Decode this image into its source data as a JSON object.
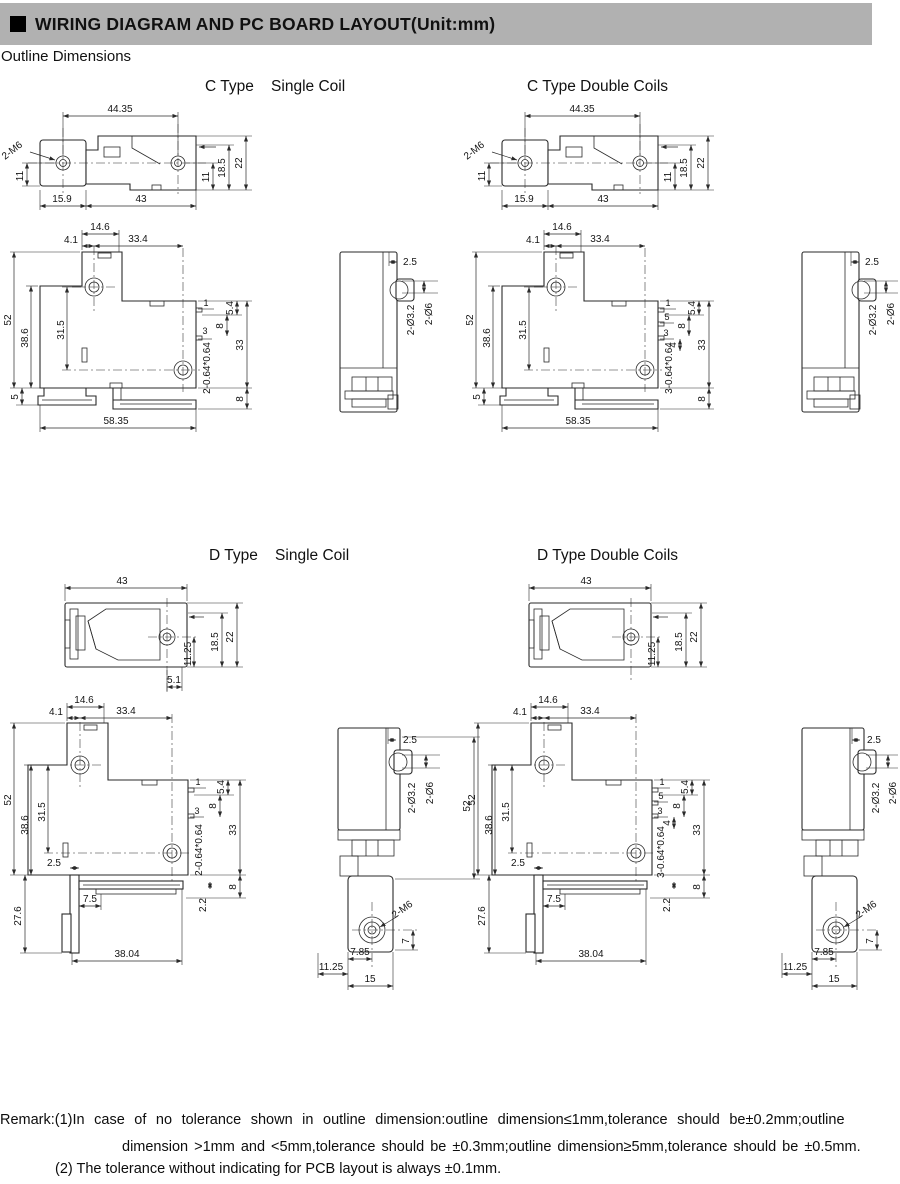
{
  "colors": {
    "header_bar": "#b1b1b1",
    "line": "#2a2a2a"
  },
  "header": {
    "title": "WIRING DIAGRAM AND PC BOARD LAYOUT(Unit:mm)"
  },
  "section_label": "Outline Dimensions",
  "drawings": {
    "c_single": {
      "title": "C Type    Single Coil",
      "top": {
        "holes_span": "44.35",
        "thread": "2-M6",
        "left_h": "11",
        "off1": "15.9",
        "off2": "43",
        "r1": "11",
        "r2": "18.5",
        "r3": "22"
      },
      "front": {
        "t1": "14.6",
        "t2": "4.1",
        "t3": "33.4",
        "l1": "52",
        "l2": "38.6",
        "l3": "31.5",
        "p1": "1",
        "p2": "5.4",
        "p3": "8",
        "p4": "3",
        "r1": "33",
        "pin": "2-0.64*0.64",
        "b1": "5",
        "b2": "58.35",
        "r2": "8"
      },
      "side": {
        "t1": "2.5",
        "h1": "2-Ø3.2",
        "h2": "2-Ø6"
      }
    },
    "c_double": {
      "title": "C Type Double Coils",
      "top": {
        "holes_span": "44.35",
        "thread": "2-M6",
        "left_h": "11",
        "off1": "15.9",
        "off2": "43",
        "r1": "11",
        "r2": "18.5",
        "r3": "22"
      },
      "front": {
        "t1": "14.6",
        "t2": "4.1",
        "t3": "33.4",
        "l1": "52",
        "l2": "38.6",
        "l3": "31.5",
        "p1": "1",
        "p2": "5.4",
        "p3": "8",
        "p4": "3",
        "p5": "5",
        "p6": "4",
        "r1": "33",
        "pin": "3-0.64*0.64",
        "b1": "5",
        "b2": "58.35",
        "r2": "8"
      },
      "side": {
        "t1": "2.5",
        "h1": "2-Ø3.2",
        "h2": "2-Ø6"
      }
    },
    "d_single": {
      "title": "D Type    Single Coil",
      "top": {
        "w": "43",
        "r1": "11.25",
        "r2": "18.5",
        "r3": "22",
        "b1": "5.1"
      },
      "front": {
        "t1": "14.6",
        "t2": "4.1",
        "t3": "33.4",
        "l1": "52",
        "l2": "38.6",
        "l3": "31.5",
        "p1": "1",
        "p2": "5.4",
        "p3": "8",
        "p4": "3",
        "r1": "33",
        "pin": "2-0.64*0.64",
        "plate": "2.5",
        "l4": "27.6",
        "b1": "7.5",
        "b2": "38.04",
        "ft": "2.2",
        "r2": "8"
      },
      "side": {
        "t1": "2.5",
        "h1": "2-Ø3.2",
        "h2": "2-Ø6",
        "h": "52",
        "thread": "2-M6",
        "d1": "7",
        "d2": "7.85",
        "d3": "11.25",
        "d4": "15"
      }
    },
    "d_double": {
      "title": "D Type Double Coils",
      "top": {
        "w": "43",
        "r1": "11.25",
        "r2": "18.5",
        "r3": "22"
      },
      "front": {
        "t1": "14.6",
        "t2": "4.1",
        "t3": "33.4",
        "l1": "52",
        "l2": "38.6",
        "l3": "31.5",
        "p1": "1",
        "p2": "5.4",
        "p3": "8",
        "p4": "3",
        "p5": "5",
        "p6": "4",
        "r1": "33",
        "pin": "3-0.64*0.64",
        "plate": "2.5",
        "l4": "27.6",
        "b1": "7.5",
        "b2": "38.04",
        "ft": "2.2",
        "r2": "8"
      },
      "side": {
        "t1": "2.5",
        "h1": "2-Ø3.2",
        "h2": "2-Ø6",
        "thread": "2-M6",
        "d1": "7",
        "d2": "7.85",
        "d3": "11.25",
        "d4": "15"
      }
    }
  },
  "remark": {
    "line1": "Remark:(1)In case of no tolerance shown in outline dimension:outline dimension≤1mm,tolerance should be±0.2mm;outline",
    "line2": "dimension >1mm and <5mm,tolerance should be ±0.3mm;outline dimension≥5mm,tolerance should be ±0.5mm.",
    "line3": "(2) The tolerance without indicating for PCB layout is always ±0.1mm."
  }
}
